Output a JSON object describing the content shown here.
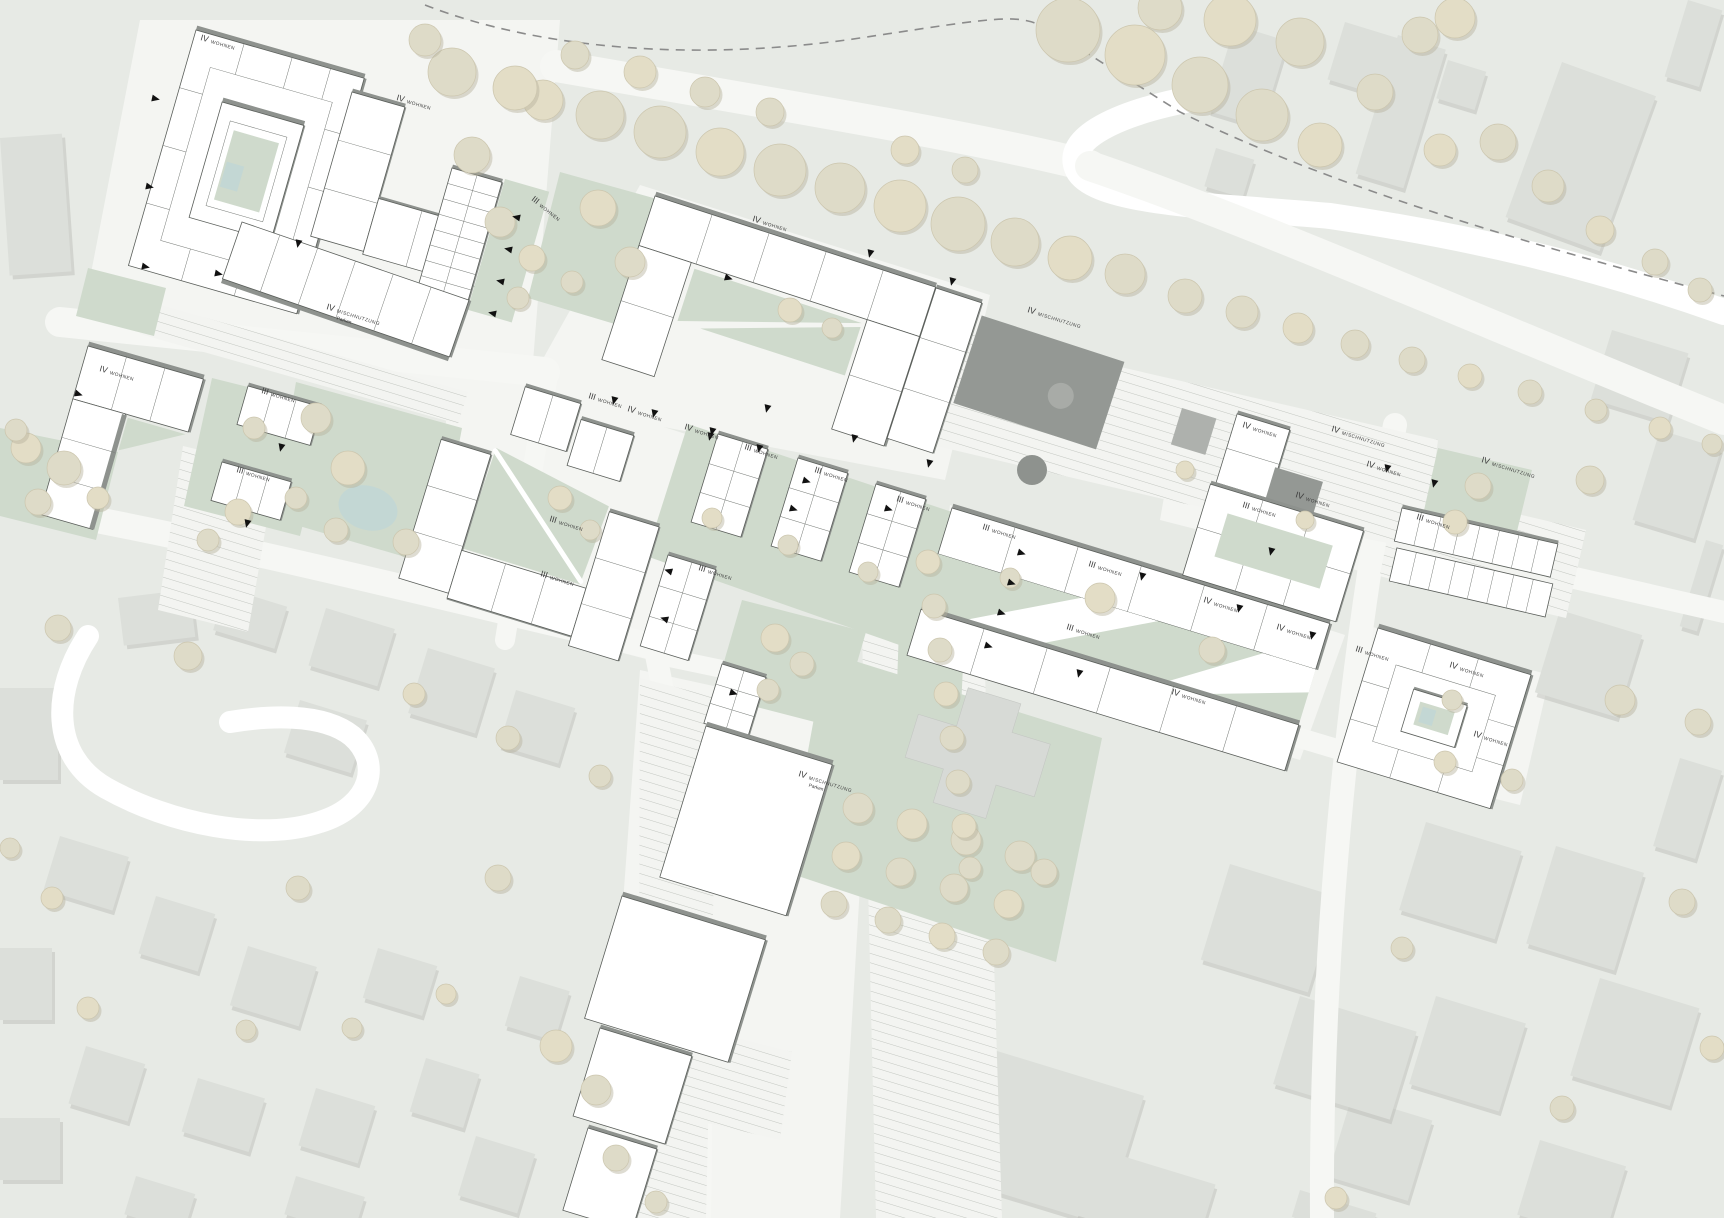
{
  "plan": {
    "type": "urban-masterplan-site-plan",
    "colors": {
      "background": "#e7eae5",
      "new_building": "#ffffff",
      "building_shadow_edge": "#8e928e",
      "context_building": "#dcdfda",
      "green_space": "#cfdacc",
      "tree": "#e3ddc6",
      "water_pond": "#c3d7d4",
      "dark_roof": "#949894",
      "road": "#f6f7f4",
      "entrance_marker": "#111111",
      "label_text": "#3c3c3c"
    },
    "legend_terms": {
      "WOHNEN": "housing use",
      "MISCHNUTZUNG": "mixed use",
      "Parken": "parking",
      "roman_numerals": "number of storeys"
    }
  },
  "labels": [
    {
      "prefix": "IV",
      "text": "WOHNEN",
      "x": 200,
      "y": 40,
      "rot": 16
    },
    {
      "prefix": "IV",
      "text": "WOHNEN",
      "x": 396,
      "y": 100,
      "rot": 16
    },
    {
      "prefix": "III",
      "text": "WOHNEN",
      "x": 531,
      "y": 200,
      "rot": 38
    },
    {
      "prefix": "IV",
      "text": "MISCHNUTZUNG",
      "sub": "Parken",
      "x": 326,
      "y": 309,
      "rot": 17
    },
    {
      "prefix": "IV",
      "text": "WOHNEN",
      "x": 752,
      "y": 221,
      "rot": 17
    },
    {
      "prefix": "IV",
      "text": "MISCHNUTZUNG",
      "x": 1027,
      "y": 312,
      "rot": 17
    },
    {
      "prefix": "III",
      "text": "WOHNEN",
      "x": 588,
      "y": 398,
      "rot": 17
    },
    {
      "prefix": "IV",
      "text": "WOHNEN",
      "x": 627,
      "y": 411,
      "rot": 17
    },
    {
      "prefix": "IV",
      "text": "WOHNEN",
      "x": 684,
      "y": 429,
      "rot": 17
    },
    {
      "prefix": "III",
      "text": "WOHNEN",
      "x": 744,
      "y": 449,
      "rot": 17
    },
    {
      "prefix": "III",
      "text": "WOHNEN",
      "x": 814,
      "y": 472,
      "rot": 17
    },
    {
      "prefix": "III",
      "text": "WOHNEN",
      "x": 896,
      "y": 501,
      "rot": 17
    },
    {
      "prefix": "IV",
      "text": "WOHNEN",
      "x": 99,
      "y": 371,
      "rot": 16
    },
    {
      "prefix": "III",
      "text": "WOHNEN",
      "x": 261,
      "y": 393,
      "rot": 16
    },
    {
      "prefix": "III",
      "text": "WOHNEN",
      "x": 236,
      "y": 472,
      "rot": 16
    },
    {
      "prefix": "III",
      "text": "WOHNEN",
      "x": 549,
      "y": 521,
      "rot": 17
    },
    {
      "prefix": "III",
      "text": "WOHNEN",
      "x": 540,
      "y": 576,
      "rot": 17
    },
    {
      "prefix": "III",
      "text": "WOHNEN",
      "x": 698,
      "y": 570,
      "rot": 17
    },
    {
      "prefix": "III",
      "text": "WOHNEN",
      "x": 982,
      "y": 529,
      "rot": 17
    },
    {
      "prefix": "III",
      "text": "WOHNEN",
      "x": 1088,
      "y": 566,
      "rot": 17
    },
    {
      "prefix": "IV",
      "text": "WOHNEN",
      "x": 1203,
      "y": 602,
      "rot": 17
    },
    {
      "prefix": "IV",
      "text": "WOHNEN",
      "x": 1276,
      "y": 629,
      "rot": 17
    },
    {
      "prefix": "III",
      "text": "WOHNEN",
      "x": 1066,
      "y": 629,
      "rot": 17
    },
    {
      "prefix": "IV",
      "text": "WOHNEN",
      "x": 1171,
      "y": 694,
      "rot": 17
    },
    {
      "prefix": "III",
      "text": "WOHNEN",
      "x": 1355,
      "y": 651,
      "rot": 17
    },
    {
      "prefix": "IV",
      "text": "WOHNEN",
      "x": 1242,
      "y": 427,
      "rot": 17
    },
    {
      "prefix": "IV",
      "text": "MISCHNUTZUNG",
      "x": 1331,
      "y": 431,
      "rot": 17
    },
    {
      "prefix": "IV",
      "text": "WOHNEN",
      "x": 1366,
      "y": 466,
      "rot": 17
    },
    {
      "prefix": "IV",
      "text": "WOHNEN",
      "x": 1295,
      "y": 497,
      "rot": 17
    },
    {
      "prefix": "IV",
      "text": "MISCHNUTZUNG",
      "x": 1481,
      "y": 462,
      "rot": 17
    },
    {
      "prefix": "III",
      "text": "WOHNEN",
      "x": 1416,
      "y": 519,
      "rot": 17
    },
    {
      "prefix": "IV",
      "text": "MISCHNUTZUNG",
      "sub": "Parken",
      "x": 798,
      "y": 776,
      "rot": 17
    },
    {
      "prefix": "IV",
      "text": "WOHNEN",
      "x": 1449,
      "y": 667,
      "rot": 17
    },
    {
      "prefix": "IV",
      "text": "WOHNEN",
      "x": 1473,
      "y": 736,
      "rot": 17
    },
    {
      "prefix": "III",
      "text": "WOHNEN",
      "x": 1242,
      "y": 507,
      "rot": 17
    }
  ]
}
